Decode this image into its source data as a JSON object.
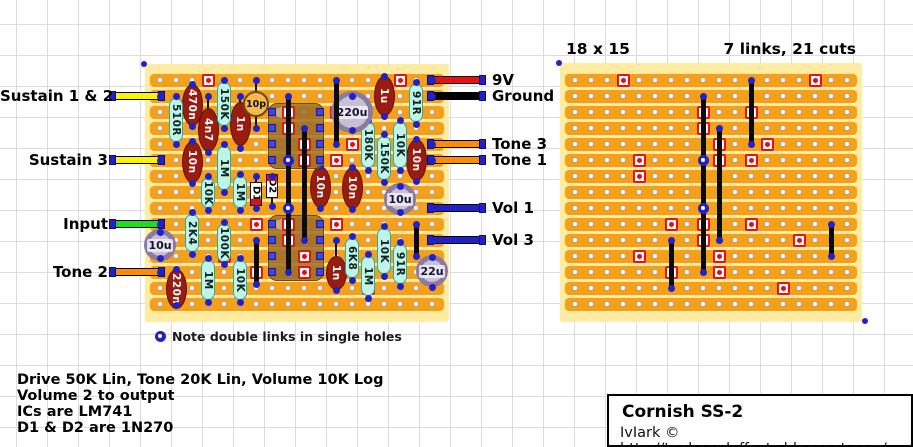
{
  "canvas": {
    "width": 913,
    "height": 447,
    "grid_color": "#dcdcdc",
    "background": "#ffffff"
  },
  "colors": {
    "strip_orange": "#F5A01A",
    "board_border_yellow": "#FFECA2",
    "cut_red": "#EC1111",
    "dot_blue": "#2121CB",
    "resistor_cyan": "#BFF4E9",
    "cap_dark_red": "#9A1B10",
    "electro_lavender": "#C9C0D6",
    "ic_brown": "#986D28",
    "link_black": "#0B0B0B",
    "wire_yellow": "#FFF200",
    "wire_green": "#21DB21",
    "wire_orange": "#FF8C00",
    "wire_red": "#EE0E0E",
    "wire_blue": "#2121CB",
    "wire_black": "#000000"
  },
  "left_board": {
    "x": 145,
    "y": 64,
    "w": 304,
    "h": 258,
    "x0": 160,
    "y0": 80,
    "pitch": 16,
    "cols": 18,
    "rows": 15
  },
  "right_board": {
    "x": 560,
    "y": 63,
    "w": 302,
    "h": 259,
    "x0": 575,
    "y0": 80,
    "pitch": 16,
    "cols": 18,
    "rows": 15,
    "size_label": "18 x 15",
    "summary_label": "7 links, 21 cuts"
  },
  "cuts_grid": [
    [
      4,
      1
    ],
    [
      16,
      1
    ],
    [
      9,
      3
    ],
    [
      12,
      3
    ],
    [
      9,
      4
    ],
    [
      10,
      5
    ],
    [
      13,
      5
    ],
    [
      5,
      6
    ],
    [
      10,
      6
    ],
    [
      12,
      6
    ],
    [
      5,
      7
    ],
    [
      7,
      10
    ],
    [
      9,
      10
    ],
    [
      12,
      10
    ],
    [
      9,
      11
    ],
    [
      15,
      11
    ],
    [
      5,
      12
    ],
    [
      10,
      12
    ],
    [
      7,
      13
    ],
    [
      10,
      13
    ],
    [
      14,
      14
    ]
  ],
  "ic_cuts_grid": [
    [
      9,
      3
    ],
    [
      9,
      4
    ],
    [
      10,
      5
    ],
    [
      10,
      6
    ],
    [
      9,
      10
    ],
    [
      9,
      11
    ],
    [
      10,
      12
    ],
    [
      10,
      13
    ]
  ],
  "left_components": {
    "resistors": [
      {
        "label": "510R",
        "x": 176,
        "y1": 96,
        "y2": 144
      },
      {
        "label": "150K",
        "x": 224,
        "y1": 80,
        "y2": 128
      },
      {
        "label": "1M",
        "x": 224,
        "y1": 144,
        "y2": 192
      },
      {
        "label": "10K",
        "x": 208,
        "y1": 176,
        "y2": 210
      },
      {
        "label": "2K4",
        "x": 192,
        "y1": 212,
        "y2": 254
      },
      {
        "label": "100K",
        "x": 224,
        "y1": 222,
        "y2": 264
      },
      {
        "label": "1M",
        "x": 208,
        "y1": 258,
        "y2": 302
      },
      {
        "label": "10K",
        "x": 240,
        "y1": 258,
        "y2": 302
      },
      {
        "label": "1M",
        "x": 240,
        "y1": 174,
        "y2": 210
      },
      {
        "label": "180K",
        "x": 368,
        "y1": 120,
        "y2": 170
      },
      {
        "label": "150K",
        "x": 384,
        "y1": 134,
        "y2": 182
      },
      {
        "label": "10K",
        "x": 400,
        "y1": 120,
        "y2": 170
      },
      {
        "label": "91R",
        "x": 416,
        "y1": 82,
        "y2": 124
      },
      {
        "label": "6K8",
        "x": 352,
        "y1": 236,
        "y2": 280
      },
      {
        "label": "1M",
        "x": 368,
        "y1": 254,
        "y2": 298
      },
      {
        "label": "10K",
        "x": 384,
        "y1": 226,
        "y2": 276
      },
      {
        "label": "91R",
        "x": 400,
        "y1": 242,
        "y2": 286
      }
    ],
    "film_caps": [
      {
        "label": "470n",
        "x": 192,
        "e1": 84,
        "e2": 126,
        "d1": 84,
        "d2": 126
      },
      {
        "label": "4n7",
        "x": 208,
        "e1": 108,
        "e2": 152,
        "d1": 96,
        "d2": 152
      },
      {
        "label": "1n",
        "x": 240,
        "e1": 102,
        "e2": 146,
        "d1": 96,
        "d2": 148
      },
      {
        "label": "10n",
        "x": 192,
        "e1": 141,
        "e2": 183,
        "d1": 141,
        "d2": 183
      },
      {
        "label": "10n",
        "x": 320,
        "e1": 166,
        "e2": 208,
        "d1": 166,
        "d2": 208
      },
      {
        "label": "10n",
        "x": 352,
        "e1": 167,
        "e2": 209,
        "d1": 167,
        "d2": 209
      },
      {
        "label": "10n",
        "x": 416,
        "e1": 139,
        "e2": 181,
        "d1": 139,
        "d2": 181
      },
      {
        "label": "1u",
        "x": 384,
        "e1": 76,
        "e2": 116,
        "d1": 76,
        "d2": 116
      },
      {
        "label": "1n",
        "x": 336,
        "e1": 256,
        "e2": 290,
        "d1": 240,
        "d2": 290
      },
      {
        "label": "220n",
        "x": 176,
        "e1": 269,
        "e2": 309,
        "d1": 269,
        "d2": 305
      }
    ],
    "disc_caps": [
      {
        "label": "10p",
        "x": 256,
        "cy": 104,
        "r": 13,
        "d1": 80,
        "d2": 128
      }
    ],
    "electro_caps": [
      {
        "label": "220u",
        "x": 352,
        "cy": 112,
        "r": 21,
        "d1": 96,
        "d2": 130
      },
      {
        "label": "10u",
        "x": 400,
        "cy": 199,
        "r": 16,
        "d1": 186,
        "d2": 212
      },
      {
        "label": "10u",
        "x": 160,
        "cy": 245,
        "r": 16,
        "d1": 232,
        "d2": 258
      },
      {
        "label": "22u",
        "x": 432,
        "cy": 271,
        "r": 16,
        "d1": 257,
        "d2": 287
      }
    ],
    "diodes": [
      {
        "label": "D1",
        "x": 256,
        "d1": 176,
        "d2": 208,
        "b1": 182,
        "b2": 206,
        "band": "bottom"
      },
      {
        "label": "D2",
        "x": 272,
        "d1": 176,
        "d2": 206,
        "b1": 174,
        "b2": 198,
        "band": "top"
      }
    ],
    "ics": [
      {
        "x1": 268,
        "x2": 324,
        "y1": 103,
        "y2": 169,
        "pin_rows": [
          112,
          128,
          144,
          160
        ]
      },
      {
        "x1": 268,
        "x2": 324,
        "y1": 215,
        "y2": 281,
        "pin_rows": [
          224,
          240,
          256,
          272
        ]
      }
    ],
    "pin_cols": [
      272,
      320
    ],
    "links": [
      {
        "x": 288,
        "y1": 96,
        "y2": 160
      },
      {
        "x": 288,
        "y1": 160,
        "y2": 208
      },
      {
        "x": 288,
        "y1": 208,
        "y2": 272
      },
      {
        "x": 304,
        "y1": 128,
        "y2": 240
      },
      {
        "x": 336,
        "y1": 80,
        "y2": 144
      },
      {
        "x": 256,
        "y1": 240,
        "y2": 284
      },
      {
        "x": 416,
        "y1": 224,
        "y2": 256
      }
    ],
    "link_joints": [
      {
        "x": 288,
        "y": 160
      },
      {
        "x": 288,
        "y": 208
      }
    ]
  },
  "right_links_grid": [
    {
      "col": 9,
      "r1": 2,
      "r2": 6
    },
    {
      "col": 9,
      "r1": 6,
      "r2": 9
    },
    {
      "col": 9,
      "r1": 9,
      "r2": 13
    },
    {
      "col": 10,
      "r1": 4,
      "r2": 11
    },
    {
      "col": 12,
      "r1": 1,
      "r2": 5
    },
    {
      "col": 7,
      "r1": 11,
      "r2": 14
    },
    {
      "col": 17,
      "r1": 10,
      "r2": 12
    }
  ],
  "right_joints_grid": [
    {
      "col": 9,
      "row": 6
    },
    {
      "col": 9,
      "row": 9
    }
  ],
  "wires_left": [
    {
      "label": "Sustain 1 & 2",
      "color": "#FFF200",
      "y": 96
    },
    {
      "label": "Sustain 3",
      "color": "#FFF200",
      "y": 160
    },
    {
      "label": "Input",
      "color": "#21DB21",
      "y": 224
    },
    {
      "label": "Tone 2",
      "color": "#FF8C00",
      "y": 272
    }
  ],
  "wires_right": [
    {
      "label": "9V",
      "color": "#EE0E0E",
      "y": 80
    },
    {
      "label": "Ground",
      "color": "#000000",
      "y": 96
    },
    {
      "label": "Tone 3",
      "color": "#FF8C00",
      "y": 144
    },
    {
      "label": "Tone 1",
      "color": "#FF8C00",
      "y": 160
    },
    {
      "label": "Vol 1",
      "color": "#2121CB",
      "y": 208
    },
    {
      "label": "Vol 3",
      "color": "#2121CB",
      "y": 240
    }
  ],
  "note": {
    "text": "Note double links in single holes",
    "marker_x": 160,
    "marker_y": 336,
    "text_x": 172,
    "text_y": 329
  },
  "info_lines": [
    "Drive 50K Lin, Tone 20K Lin, Volume 10K Log",
    "Volume 2 to output",
    "ICs are LM741",
    "D1 & D2 are 1N270"
  ],
  "title_box": {
    "title": "Cornish SS-2",
    "credit": "IvIark © http://tagboardeffects.blogspot.com/",
    "x": 607,
    "y": 394,
    "w": 306,
    "h": 53
  },
  "corner_dots": [
    [
      144,
      64
    ],
    [
      559,
      63
    ],
    [
      865,
      321
    ]
  ]
}
